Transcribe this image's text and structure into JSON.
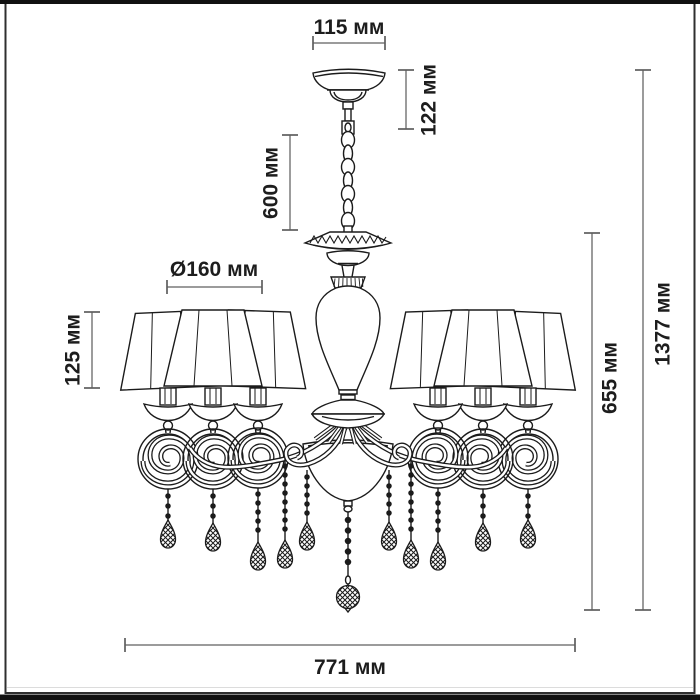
{
  "diagram": {
    "subject": "chandelier-dimension-drawing",
    "unit": "мм",
    "dims": {
      "canopy_width": {
        "label": "115 мм",
        "value": 115
      },
      "canopy_height": {
        "label": "122 мм",
        "value": 122
      },
      "chain_length": {
        "label": "600 мм",
        "value": 600
      },
      "shade_diameter": {
        "label": "Ø160 мм",
        "value": 160
      },
      "shade_height": {
        "label": "125 мм",
        "value": 125
      },
      "body_height": {
        "label": "655 мм",
        "value": 655
      },
      "total_height": {
        "label": "1377 мм",
        "value": 1377
      },
      "total_width": {
        "label": "771 мм",
        "value": 771
      }
    },
    "colors": {
      "background": "#ffffff",
      "drawing_line": "#1b1b1b",
      "dimension_line": "#7a7a7a",
      "label_text": "#1d1d1d",
      "frame_border": "#2f2f2f",
      "edge_band": "#111111"
    }
  }
}
